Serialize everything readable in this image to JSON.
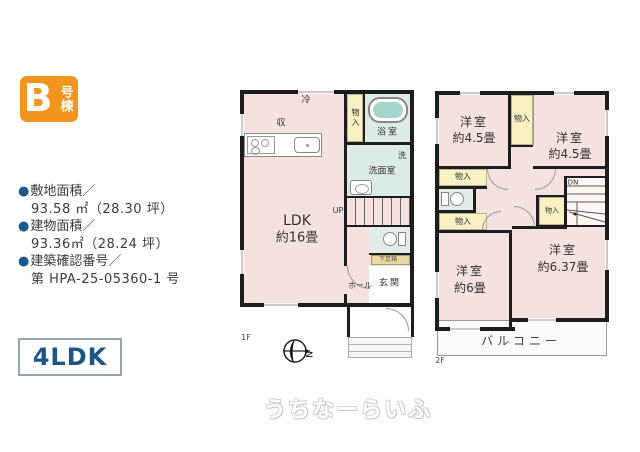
{
  "badge": {
    "letter": "B",
    "suffix": "号棟"
  },
  "info": {
    "bullet": "●",
    "items": [
      {
        "label": "敷地面積／",
        "value": "93.58 ㎡（28.30 坪）"
      },
      {
        "label": "建物面積／",
        "value": "93.36㎡（28.24 坪）"
      },
      {
        "label": "建築確認番号／",
        "value": "第 HPA-25-05360-1 号"
      }
    ]
  },
  "plan_type": "4LDK",
  "floor1": {
    "floor_label": "1F",
    "ldk_name": "LDK",
    "ldk_size": "約16畳",
    "fridge": "冷",
    "storage": "収",
    "closet": "物入",
    "bathroom": "浴室",
    "laundry": "洗",
    "washroom": "洗面室",
    "up": "UP",
    "shoe_box": "下足箱",
    "hall": "ホール",
    "entrance": "玄関",
    "compass_north": "N"
  },
  "floor2": {
    "floor_label": "2F",
    "room_nw_name": "洋室",
    "room_nw_size": "約4.5畳",
    "room_ne_name": "洋室",
    "room_ne_size": "約4.5畳",
    "room_sw_name": "洋室",
    "room_sw_size": "約6畳",
    "room_se_name": "洋室",
    "room_se_size": "約6.37畳",
    "closet": "物入",
    "dn": "DN",
    "balcony": "バルコニー"
  },
  "watermark": "うちなーらいふ",
  "colors": {
    "accent_orange": "#f3941e",
    "accent_blue": "#1b5a8c",
    "room_pink": "#f5e1df",
    "closet_yellow": "#f7f1c3",
    "wet_area_blue": "#dcebe7",
    "tub_water": "#a4d5c9",
    "wall_black": "#1d1d1d"
  }
}
